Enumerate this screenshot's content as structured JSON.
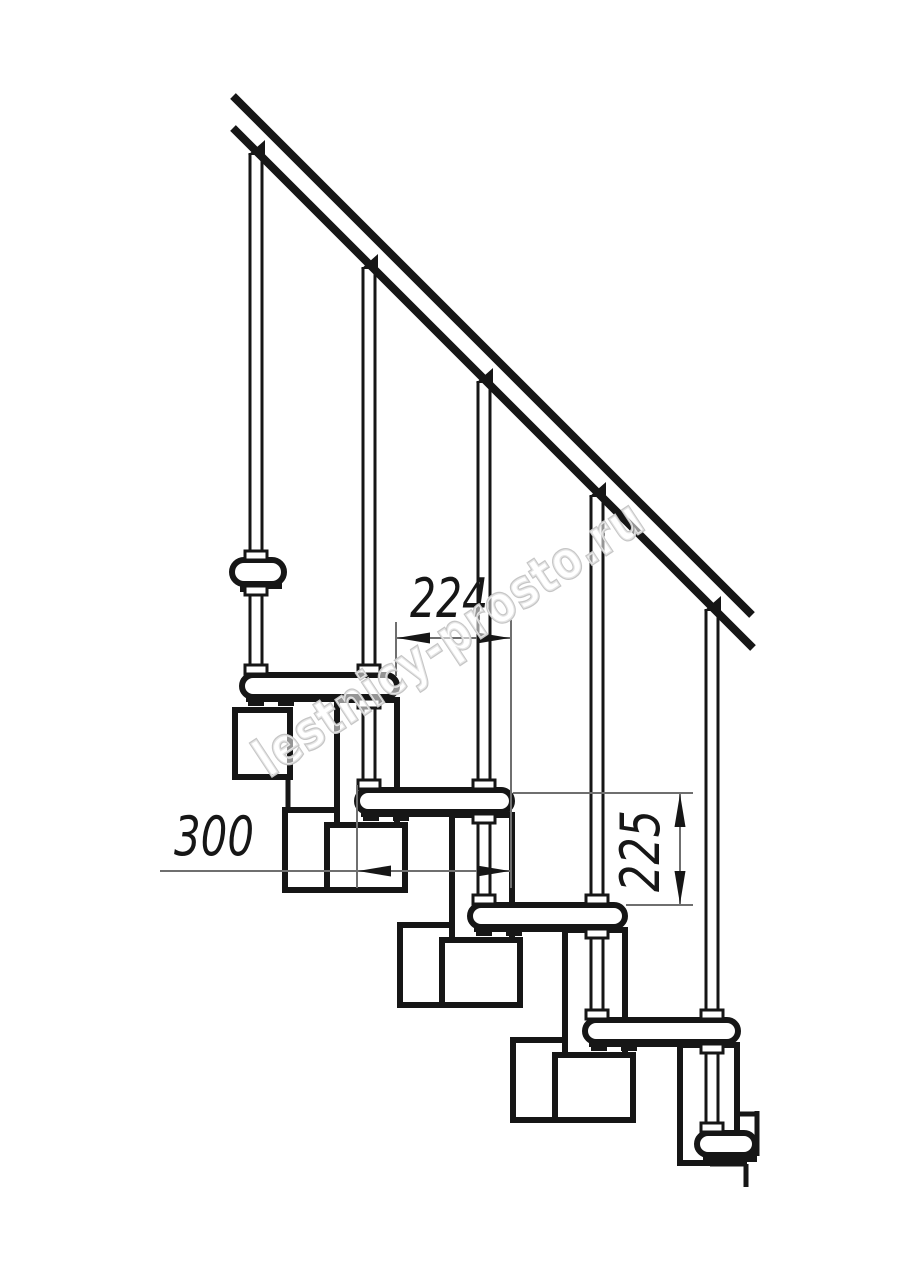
{
  "page": {
    "title": "Modular staircase side-view technical drawing",
    "background_color": "#ffffff",
    "line_color": "#161616",
    "thin_line_color": "#6f6f6f",
    "watermark_color": "#c6c6c6"
  },
  "dimensions": {
    "d224": {
      "label": "224"
    },
    "d300": {
      "label": "300"
    },
    "d225": {
      "label": "225"
    }
  },
  "watermark": {
    "text": "lestnicy-prosto.ru"
  },
  "drawing": {
    "boxes": [
      {
        "n": "support-box-a",
        "x": 235,
        "y": 710,
        "w": 55,
        "h": 67
      },
      {
        "n": "column-b",
        "x": 337,
        "y": 700,
        "w": 60,
        "h": 125
      },
      {
        "n": "sleeve-box-b",
        "x": 285,
        "y": 810,
        "w": 52,
        "h": 80
      },
      {
        "n": "module-box-b",
        "x": 327,
        "y": 825,
        "w": 78,
        "h": 65
      },
      {
        "n": "column-c",
        "x": 452,
        "y": 815,
        "w": 60,
        "h": 125
      },
      {
        "n": "sleeve-box-c",
        "x": 400,
        "y": 925,
        "w": 52,
        "h": 80
      },
      {
        "n": "module-box-c",
        "x": 442,
        "y": 940,
        "w": 78,
        "h": 65
      },
      {
        "n": "column-d",
        "x": 565,
        "y": 930,
        "w": 60,
        "h": 125
      },
      {
        "n": "sleeve-box-d",
        "x": 513,
        "y": 1040,
        "w": 52,
        "h": 80
      },
      {
        "n": "module-box-d",
        "x": 555,
        "y": 1055,
        "w": 78,
        "h": 65
      },
      {
        "n": "column-e",
        "x": 680,
        "y": 1045,
        "w": 57,
        "h": 118
      }
    ],
    "lines": [
      {
        "x1": 288,
        "y1": 777,
        "x2": 288,
        "y2": 812,
        "sw": 5
      },
      {
        "x1": 737,
        "y1": 1114,
        "x2": 757,
        "y2": 1114,
        "sw": 5
      },
      {
        "x1": 757,
        "y1": 1111,
        "x2": 757,
        "y2": 1156,
        "sw": 5
      },
      {
        "x1": 710,
        "y1": 1164,
        "x2": 747,
        "y2": 1164,
        "sw": 5
      },
      {
        "x1": 746,
        "y1": 1164,
        "x2": 746,
        "y2": 1187,
        "sw": 5
      }
    ],
    "treads": [
      {
        "n": "tread-1",
        "x": 232,
        "y": 560,
        "w": 52,
        "h": 24,
        "rx": 12
      },
      {
        "n": "tread-2",
        "x": 242,
        "y": 675,
        "w": 155,
        "h": 22,
        "rx": 11
      },
      {
        "n": "tread-3",
        "x": 357,
        "y": 790,
        "w": 155,
        "h": 22,
        "rx": 11
      },
      {
        "n": "tread-4",
        "x": 470,
        "y": 905,
        "w": 155,
        "h": 22,
        "rx": 11
      },
      {
        "n": "tread-5",
        "x": 585,
        "y": 1020,
        "w": 153,
        "h": 22,
        "rx": 11
      },
      {
        "n": "tread-6",
        "x": 697,
        "y": 1133,
        "w": 58,
        "h": 22,
        "rx": 11
      }
    ],
    "tabs": [
      {
        "x": 240,
        "y": 583,
        "w": 22,
        "h": 9
      },
      {
        "x": 240,
        "y": 583,
        "w": 42,
        "h": 6
      },
      {
        "x": 246,
        "y": 696,
        "w": 90,
        "h": 6
      },
      {
        "x": 248,
        "y": 696,
        "w": 16,
        "h": 10
      },
      {
        "x": 278,
        "y": 696,
        "w": 16,
        "h": 10
      },
      {
        "x": 361,
        "y": 811,
        "w": 90,
        "h": 6
      },
      {
        "x": 363,
        "y": 811,
        "w": 16,
        "h": 10
      },
      {
        "x": 393,
        "y": 811,
        "w": 16,
        "h": 10
      },
      {
        "x": 474,
        "y": 926,
        "w": 90,
        "h": 6
      },
      {
        "x": 476,
        "y": 926,
        "w": 16,
        "h": 10
      },
      {
        "x": 506,
        "y": 926,
        "w": 16,
        "h": 10
      },
      {
        "x": 589,
        "y": 1041,
        "w": 90,
        "h": 6
      },
      {
        "x": 591,
        "y": 1041,
        "w": 16,
        "h": 10
      },
      {
        "x": 621,
        "y": 1041,
        "w": 16,
        "h": 10
      },
      {
        "x": 703,
        "y": 1153,
        "w": 54,
        "h": 9
      }
    ],
    "tubes": [
      {
        "n": "baluster-1",
        "cx": 256,
        "y1": 153,
        "y2": 560
      },
      {
        "n": "post-1",
        "cx": 256,
        "y1": 584,
        "y2": 674
      },
      {
        "n": "baluster-2",
        "cx": 369,
        "y1": 267,
        "y2": 674
      },
      {
        "n": "post-2",
        "cx": 369,
        "y1": 697,
        "y2": 789
      },
      {
        "n": "baluster-3",
        "cx": 484,
        "y1": 381,
        "y2": 789
      },
      {
        "n": "post-3",
        "cx": 484,
        "y1": 812,
        "y2": 904
      },
      {
        "n": "baluster-4",
        "cx": 597,
        "y1": 495,
        "y2": 904
      },
      {
        "n": "post-4",
        "cx": 597,
        "y1": 927,
        "y2": 1019
      },
      {
        "n": "baluster-5",
        "cx": 712,
        "y1": 609,
        "y2": 1019
      },
      {
        "n": "post-5",
        "cx": 712,
        "y1": 1042,
        "y2": 1132
      }
    ],
    "collars": [
      {
        "x": 245,
        "y": 551
      },
      {
        "x": 245,
        "y": 586
      },
      {
        "x": 245,
        "y": 665
      },
      {
        "x": 358,
        "y": 665
      },
      {
        "x": 358,
        "y": 699
      },
      {
        "x": 358,
        "y": 780
      },
      {
        "x": 473,
        "y": 780
      },
      {
        "x": 473,
        "y": 814
      },
      {
        "x": 473,
        "y": 895
      },
      {
        "x": 586,
        "y": 895
      },
      {
        "x": 586,
        "y": 929
      },
      {
        "x": 586,
        "y": 1010
      },
      {
        "x": 701,
        "y": 1010
      },
      {
        "x": 701,
        "y": 1044
      },
      {
        "x": 701,
        "y": 1123
      }
    ],
    "rails": [
      {
        "x1": 233,
        "y1": 96,
        "x2": 752,
        "y2": 615,
        "sw": 8
      },
      {
        "x1": 233,
        "y1": 128,
        "x2": 753,
        "y2": 648,
        "sw": 8
      }
    ],
    "wedges": [
      {
        "x": 256,
        "y": 155
      },
      {
        "x": 369,
        "y": 269
      },
      {
        "x": 484,
        "y": 383
      },
      {
        "x": 597,
        "y": 497
      },
      {
        "x": 712,
        "y": 611
      }
    ],
    "thin": [
      {
        "x1": 396,
        "y1": 622,
        "x2": 396,
        "y2": 676
      },
      {
        "x1": 511,
        "y1": 620,
        "x2": 511,
        "y2": 888
      },
      {
        "x1": 357,
        "y1": 785,
        "x2": 357,
        "y2": 888
      },
      {
        "x1": 396,
        "y1": 638,
        "x2": 511,
        "y2": 638
      },
      {
        "x1": 160,
        "y1": 871,
        "x2": 511,
        "y2": 871
      },
      {
        "x1": 513,
        "y1": 793,
        "x2": 693,
        "y2": 793
      },
      {
        "x1": 626,
        "y1": 905,
        "x2": 693,
        "y2": 905
      },
      {
        "x1": 680,
        "y1": 793,
        "x2": 680,
        "y2": 905
      }
    ],
    "arrows": [
      {
        "x": 397,
        "y": 638,
        "dir": "left"
      },
      {
        "x": 510,
        "y": 638,
        "dir": "right"
      },
      {
        "x": 358,
        "y": 871,
        "dir": "left"
      },
      {
        "x": 510,
        "y": 871,
        "dir": "right"
      },
      {
        "x": 680,
        "y": 794,
        "dir": "up"
      },
      {
        "x": 680,
        "y": 904,
        "dir": "down"
      }
    ]
  }
}
